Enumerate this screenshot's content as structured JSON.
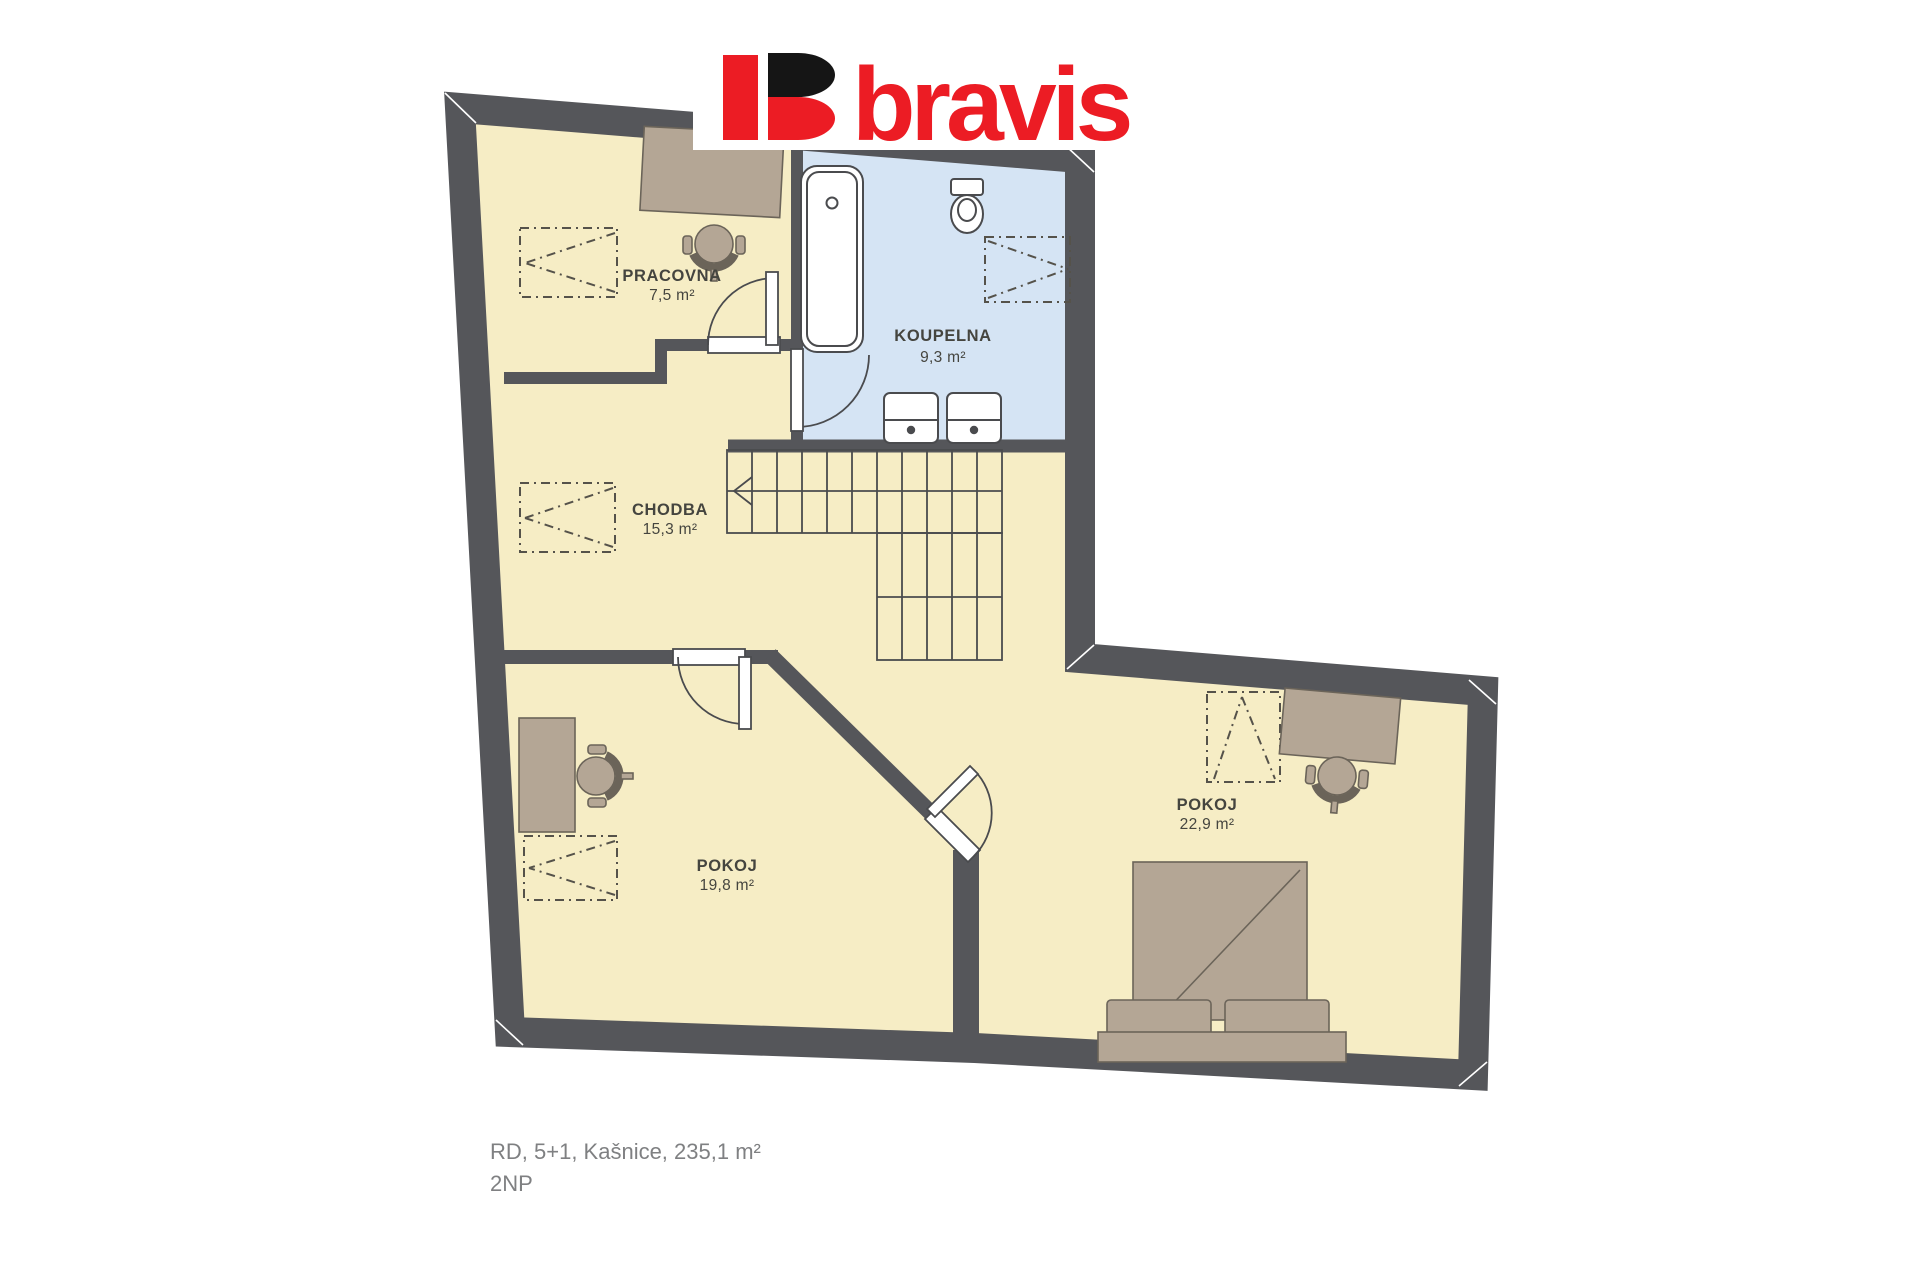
{
  "logo": {
    "text": "bravis"
  },
  "plan": {
    "rooms": [
      {
        "name": "PRACOVNA",
        "area": "7,5 m²"
      },
      {
        "name": "KOUPELNA",
        "area": "9,3 m²"
      },
      {
        "name": "CHODBA",
        "area": "15,3 m²"
      },
      {
        "name": "POKOJ",
        "area": "19,8 m²"
      },
      {
        "name": "POKOJ",
        "area": "22,9 m²"
      }
    ],
    "caption": {
      "line1": "RD, 5+1, Kašnice, 235,1 m²",
      "line2": "2NP"
    }
  },
  "colors": {
    "wall": "#55565A",
    "floor": "#F6EDC5",
    "bathroom": "#D5E4F4",
    "fixture_line": "#4A4B4E",
    "fixture_fill": "#FFFFFF",
    "furniture": "#B4A695",
    "furniture_line": "#6B6459",
    "dashed": "#55524A",
    "label": "#45453F",
    "caption": "#7F8082",
    "brand_red": "#EC1C24",
    "brand_black": "#151515",
    "white": "#FFFFFF"
  }
}
